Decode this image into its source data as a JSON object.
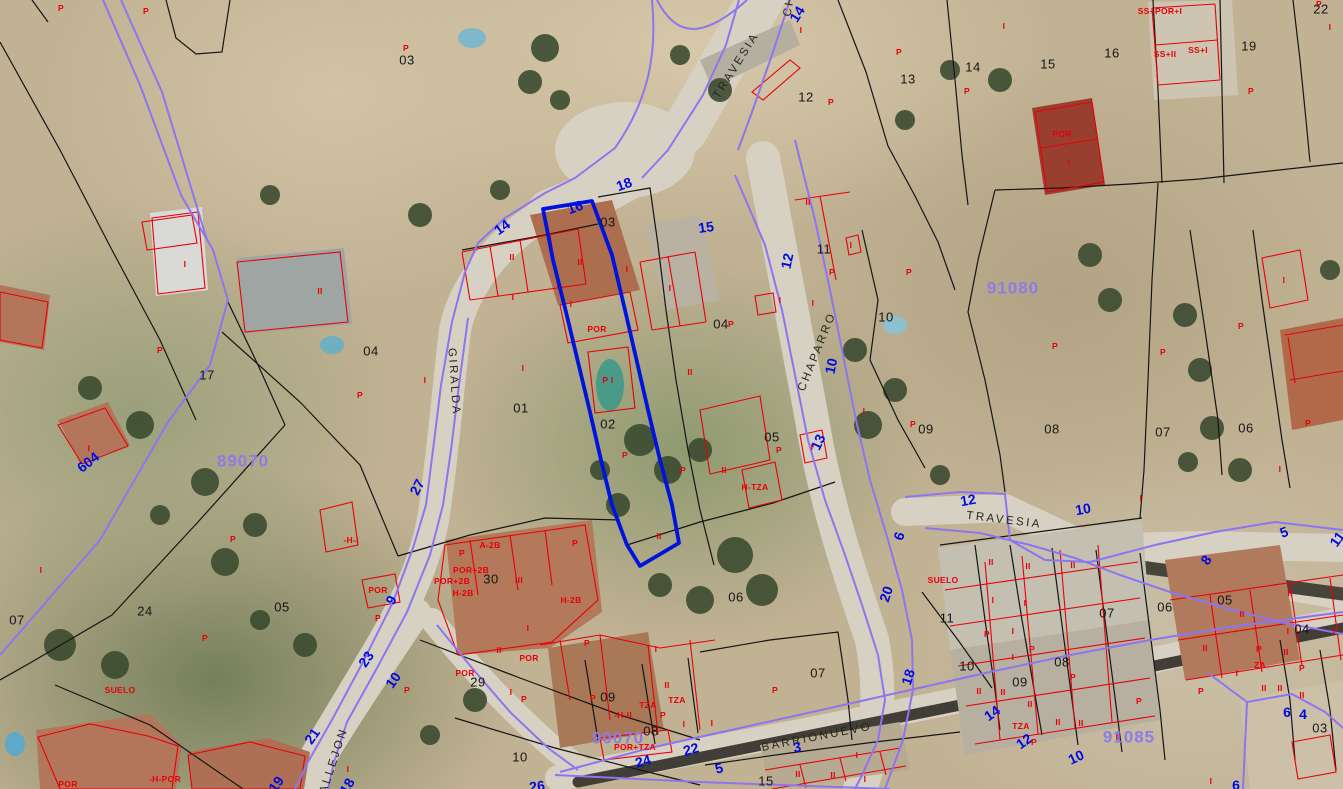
{
  "map": {
    "type": "cadastral-aerial-view",
    "colors": {
      "selected_parcel": "#0013dc",
      "parcel_lines": "#151515",
      "building_lines": "#e80008",
      "street_boundary": "#8d75f0",
      "street_numbers": "#0009e2",
      "block_numbers": "#8d7ce8",
      "building_labels": "#e80008",
      "street_names": "#26261c"
    },
    "street_names": [
      {
        "text": "TRAVESIA",
        "x": 737,
        "y": 66,
        "rot": -58
      },
      {
        "text": "GIRALDA",
        "x": 453,
        "y": 382,
        "rot": 86
      },
      {
        "text": "CHAPARRO",
        "x": 818,
        "y": 352,
        "rot": -68
      },
      {
        "text": "TRAVESIA",
        "x": 1004,
        "y": 521,
        "rot": 7
      },
      {
        "text": "BARRIONUEVO",
        "x": 817,
        "y": 738,
        "rot": -11
      },
      {
        "text": "CALLEJON",
        "x": 333,
        "y": 766,
        "rot": -72
      },
      {
        "text": "CH",
        "x": 790,
        "y": 6,
        "rot": -80
      }
    ],
    "street_numbers": [
      {
        "text": "14",
        "x": 797,
        "y": 14,
        "rot": -58
      },
      {
        "text": "18",
        "x": 624,
        "y": 184,
        "rot": -20
      },
      {
        "text": "16",
        "x": 575,
        "y": 207,
        "rot": -20
      },
      {
        "text": "15",
        "x": 706,
        "y": 227,
        "rot": -8
      },
      {
        "text": "14",
        "x": 502,
        "y": 227,
        "rot": -35
      },
      {
        "text": "12",
        "x": 787,
        "y": 261,
        "rot": -78
      },
      {
        "text": "10",
        "x": 831,
        "y": 366,
        "rot": -78
      },
      {
        "text": "13",
        "x": 818,
        "y": 442,
        "rot": -65
      },
      {
        "text": "27",
        "x": 417,
        "y": 487,
        "rot": -62
      },
      {
        "text": "9",
        "x": 391,
        "y": 600,
        "rot": -62
      },
      {
        "text": "23",
        "x": 366,
        "y": 659,
        "rot": -55
      },
      {
        "text": "10",
        "x": 393,
        "y": 680,
        "rot": -55
      },
      {
        "text": "21",
        "x": 312,
        "y": 736,
        "rot": -55
      },
      {
        "text": "19",
        "x": 276,
        "y": 784,
        "rot": -55
      },
      {
        "text": "18",
        "x": 347,
        "y": 786,
        "rot": -60
      },
      {
        "text": "604",
        "x": 88,
        "y": 462,
        "rot": -38
      },
      {
        "text": "20",
        "x": 886,
        "y": 594,
        "rot": -72
      },
      {
        "text": "6",
        "x": 899,
        "y": 536,
        "rot": -72
      },
      {
        "text": "18",
        "x": 908,
        "y": 677,
        "rot": -72
      },
      {
        "text": "12",
        "x": 968,
        "y": 500,
        "rot": -10
      },
      {
        "text": "10",
        "x": 1083,
        "y": 509,
        "rot": -10
      },
      {
        "text": "8",
        "x": 1206,
        "y": 560,
        "rot": -55
      },
      {
        "text": "5",
        "x": 1284,
        "y": 532,
        "rot": -20
      },
      {
        "text": "11",
        "x": 1337,
        "y": 539,
        "rot": -55
      },
      {
        "text": "14",
        "x": 992,
        "y": 713,
        "rot": -35
      },
      {
        "text": "12",
        "x": 1024,
        "y": 741,
        "rot": -35
      },
      {
        "text": "10",
        "x": 1076,
        "y": 757,
        "rot": -25
      },
      {
        "text": "6",
        "x": 1287,
        "y": 712,
        "rot": 0
      },
      {
        "text": "4",
        "x": 1303,
        "y": 714,
        "rot": 0
      },
      {
        "text": "26",
        "x": 537,
        "y": 786,
        "rot": -8
      },
      {
        "text": "24",
        "x": 643,
        "y": 761,
        "rot": -15
      },
      {
        "text": "22",
        "x": 691,
        "y": 749,
        "rot": -15
      },
      {
        "text": "5",
        "x": 719,
        "y": 768,
        "rot": -15
      },
      {
        "text": "3",
        "x": 797,
        "y": 747,
        "rot": -12
      },
      {
        "text": "6",
        "x": 1236,
        "y": 785,
        "rot": 0
      }
    ],
    "block_numbers": [
      {
        "text": "89070",
        "x": 243,
        "y": 461
      },
      {
        "text": "91080",
        "x": 1013,
        "y": 288
      },
      {
        "text": "90070",
        "x": 618,
        "y": 738
      },
      {
        "text": "91085",
        "x": 1129,
        "y": 737
      }
    ],
    "parcel_numbers": [
      {
        "text": "03",
        "x": 407,
        "y": 60
      },
      {
        "text": "12",
        "x": 806,
        "y": 97
      },
      {
        "text": "13",
        "x": 908,
        "y": 79
      },
      {
        "text": "14",
        "x": 973,
        "y": 67
      },
      {
        "text": "15",
        "x": 1048,
        "y": 64
      },
      {
        "text": "16",
        "x": 1112,
        "y": 53
      },
      {
        "text": "19",
        "x": 1249,
        "y": 46
      },
      {
        "text": "22",
        "x": 1321,
        "y": 9
      },
      {
        "text": "03",
        "x": 608,
        "y": 222
      },
      {
        "text": "11",
        "x": 824,
        "y": 249
      },
      {
        "text": "04",
        "x": 721,
        "y": 324
      },
      {
        "text": "10",
        "x": 886,
        "y": 317
      },
      {
        "text": "17",
        "x": 207,
        "y": 375
      },
      {
        "text": "04",
        "x": 371,
        "y": 351
      },
      {
        "text": "01",
        "x": 521,
        "y": 408
      },
      {
        "text": "02",
        "x": 608,
        "y": 424
      },
      {
        "text": "05",
        "x": 772,
        "y": 437
      },
      {
        "text": "09",
        "x": 926,
        "y": 429
      },
      {
        "text": "08",
        "x": 1052,
        "y": 429
      },
      {
        "text": "07",
        "x": 1163,
        "y": 432
      },
      {
        "text": "06",
        "x": 1246,
        "y": 428
      },
      {
        "text": "07",
        "x": 17,
        "y": 620
      },
      {
        "text": "24",
        "x": 145,
        "y": 611
      },
      {
        "text": "05",
        "x": 282,
        "y": 607
      },
      {
        "text": "30",
        "x": 491,
        "y": 579
      },
      {
        "text": "06",
        "x": 736,
        "y": 597
      },
      {
        "text": "29",
        "x": 478,
        "y": 682
      },
      {
        "text": "10",
        "x": 520,
        "y": 757
      },
      {
        "text": "09",
        "x": 608,
        "y": 697
      },
      {
        "text": "08",
        "x": 651,
        "y": 731
      },
      {
        "text": "07",
        "x": 818,
        "y": 673
      },
      {
        "text": "15",
        "x": 766,
        "y": 781
      },
      {
        "text": "11",
        "x": 947,
        "y": 618
      },
      {
        "text": "10",
        "x": 967,
        "y": 666
      },
      {
        "text": "09",
        "x": 1020,
        "y": 682
      },
      {
        "text": "08",
        "x": 1062,
        "y": 662
      },
      {
        "text": "07",
        "x": 1107,
        "y": 613
      },
      {
        "text": "06",
        "x": 1165,
        "y": 607
      },
      {
        "text": "05",
        "x": 1225,
        "y": 600
      },
      {
        "text": "04",
        "x": 1302,
        "y": 629
      },
      {
        "text": "03",
        "x": 1320,
        "y": 728
      }
    ],
    "building_labels": [
      {
        "text": "P",
        "x": 61,
        "y": 8
      },
      {
        "text": "P",
        "x": 146,
        "y": 11
      },
      {
        "text": "P",
        "x": 406,
        "y": 48
      },
      {
        "text": "I",
        "x": 801,
        "y": 30
      },
      {
        "text": "P",
        "x": 899,
        "y": 52
      },
      {
        "text": "P",
        "x": 831,
        "y": 102
      },
      {
        "text": "P",
        "x": 967,
        "y": 91
      },
      {
        "text": "I",
        "x": 1004,
        "y": 26
      },
      {
        "text": "SS+POR+I",
        "x": 1160,
        "y": 11
      },
      {
        "text": "SS+II",
        "x": 1165,
        "y": 54
      },
      {
        "text": "SS+I",
        "x": 1198,
        "y": 50
      },
      {
        "text": "P",
        "x": 1319,
        "y": 4
      },
      {
        "text": "I",
        "x": 1330,
        "y": 27
      },
      {
        "text": "P",
        "x": 1251,
        "y": 91
      },
      {
        "text": "POR",
        "x": 1062,
        "y": 134
      },
      {
        "text": "I",
        "x": 1069,
        "y": 163
      },
      {
        "text": "II",
        "x": 808,
        "y": 202
      },
      {
        "text": "I",
        "x": 185,
        "y": 264
      },
      {
        "text": "II",
        "x": 320,
        "y": 291
      },
      {
        "text": "P",
        "x": 160,
        "y": 350
      },
      {
        "text": "II",
        "x": 512,
        "y": 257
      },
      {
        "text": "II",
        "x": 580,
        "y": 262
      },
      {
        "text": "I",
        "x": 627,
        "y": 269
      },
      {
        "text": "I",
        "x": 513,
        "y": 297
      },
      {
        "text": "I",
        "x": 571,
        "y": 304
      },
      {
        "text": "I",
        "x": 670,
        "y": 288
      },
      {
        "text": "POR",
        "x": 597,
        "y": 329
      },
      {
        "text": "P I",
        "x": 608,
        "y": 380
      },
      {
        "text": "I",
        "x": 523,
        "y": 368
      },
      {
        "text": "II",
        "x": 690,
        "y": 372
      },
      {
        "text": "I",
        "x": 780,
        "y": 300
      },
      {
        "text": "P",
        "x": 731,
        "y": 324
      },
      {
        "text": "I",
        "x": 851,
        "y": 245
      },
      {
        "text": "P",
        "x": 832,
        "y": 272
      },
      {
        "text": "P",
        "x": 909,
        "y": 272
      },
      {
        "text": "I",
        "x": 813,
        "y": 303
      },
      {
        "text": "P",
        "x": 1055,
        "y": 346
      },
      {
        "text": "I",
        "x": 864,
        "y": 411
      },
      {
        "text": "P",
        "x": 913,
        "y": 424
      },
      {
        "text": "P",
        "x": 360,
        "y": 395
      },
      {
        "text": "I",
        "x": 425,
        "y": 380
      },
      {
        "text": "I",
        "x": 89,
        "y": 448
      },
      {
        "text": "I",
        "x": 41,
        "y": 570
      },
      {
        "text": "P",
        "x": 233,
        "y": 539
      },
      {
        "text": "-H-I",
        "x": 351,
        "y": 540
      },
      {
        "text": "P",
        "x": 205,
        "y": 638
      },
      {
        "text": "SUELO",
        "x": 120,
        "y": 690
      },
      {
        "text": "POR",
        "x": 68,
        "y": 784
      },
      {
        "text": "-H-POR",
        "x": 165,
        "y": 779
      },
      {
        "text": "POR",
        "x": 378,
        "y": 590
      },
      {
        "text": "P",
        "x": 378,
        "y": 618
      },
      {
        "text": "I",
        "x": 348,
        "y": 769
      },
      {
        "text": "P",
        "x": 407,
        "y": 690
      },
      {
        "text": "A-2B",
        "x": 490,
        "y": 545
      },
      {
        "text": "POR+2B",
        "x": 471,
        "y": 570
      },
      {
        "text": "POR+2B",
        "x": 452,
        "y": 581
      },
      {
        "text": "H-2B",
        "x": 463,
        "y": 593
      },
      {
        "text": "III",
        "x": 519,
        "y": 580
      },
      {
        "text": "P",
        "x": 462,
        "y": 553
      },
      {
        "text": "P",
        "x": 575,
        "y": 543
      },
      {
        "text": "H-2B",
        "x": 571,
        "y": 600
      },
      {
        "text": "I",
        "x": 528,
        "y": 628
      },
      {
        "text": "II",
        "x": 499,
        "y": 650
      },
      {
        "text": "POR",
        "x": 529,
        "y": 658
      },
      {
        "text": "POR",
        "x": 465,
        "y": 673
      },
      {
        "text": "I",
        "x": 511,
        "y": 692
      },
      {
        "text": "P",
        "x": 524,
        "y": 699
      },
      {
        "text": "P",
        "x": 587,
        "y": 643
      },
      {
        "text": "I",
        "x": 656,
        "y": 649
      },
      {
        "text": "P",
        "x": 625,
        "y": 455
      },
      {
        "text": "P",
        "x": 683,
        "y": 470
      },
      {
        "text": "II",
        "x": 724,
        "y": 470
      },
      {
        "text": "H-TZA",
        "x": 755,
        "y": 487
      },
      {
        "text": "P",
        "x": 779,
        "y": 450
      },
      {
        "text": "I",
        "x": 812,
        "y": 447
      },
      {
        "text": "II",
        "x": 659,
        "y": 536
      },
      {
        "text": "II",
        "x": 667,
        "y": 685
      },
      {
        "text": "TZA",
        "x": 648,
        "y": 705
      },
      {
        "text": "TZA",
        "x": 677,
        "y": 700
      },
      {
        "text": "-H-II",
        "x": 623,
        "y": 715
      },
      {
        "text": "P",
        "x": 663,
        "y": 715
      },
      {
        "text": "I",
        "x": 684,
        "y": 724
      },
      {
        "text": "I",
        "x": 712,
        "y": 723
      },
      {
        "text": "POR+TZA",
        "x": 635,
        "y": 747
      },
      {
        "text": "P",
        "x": 593,
        "y": 698
      },
      {
        "text": "P",
        "x": 775,
        "y": 690
      },
      {
        "text": "II",
        "x": 798,
        "y": 774
      },
      {
        "text": "II",
        "x": 833,
        "y": 775
      },
      {
        "text": "I",
        "x": 857,
        "y": 755
      },
      {
        "text": "I",
        "x": 865,
        "y": 779
      },
      {
        "text": "SUELO",
        "x": 943,
        "y": 580
      },
      {
        "text": "II",
        "x": 991,
        "y": 562
      },
      {
        "text": "II",
        "x": 1028,
        "y": 566
      },
      {
        "text": "II",
        "x": 1073,
        "y": 565
      },
      {
        "text": "I",
        "x": 993,
        "y": 600
      },
      {
        "text": "I",
        "x": 1025,
        "y": 603
      },
      {
        "text": "I",
        "x": 1060,
        "y": 608
      },
      {
        "text": "P",
        "x": 987,
        "y": 634
      },
      {
        "text": "I",
        "x": 1013,
        "y": 631
      },
      {
        "text": "P",
        "x": 1032,
        "y": 649
      },
      {
        "text": "I",
        "x": 1013,
        "y": 657
      },
      {
        "text": "P",
        "x": 1073,
        "y": 677
      },
      {
        "text": "II",
        "x": 979,
        "y": 691
      },
      {
        "text": "II",
        "x": 1003,
        "y": 692
      },
      {
        "text": "II",
        "x": 1030,
        "y": 704
      },
      {
        "text": "TZA",
        "x": 1021,
        "y": 726
      },
      {
        "text": "II",
        "x": 1058,
        "y": 722
      },
      {
        "text": "II",
        "x": 1081,
        "y": 723
      },
      {
        "text": "P",
        "x": 1034,
        "y": 742
      },
      {
        "text": "P",
        "x": 1139,
        "y": 701
      },
      {
        "text": "I",
        "x": 1117,
        "y": 737
      },
      {
        "text": "I",
        "x": 1141,
        "y": 498
      },
      {
        "text": "II",
        "x": 1290,
        "y": 593
      },
      {
        "text": "II",
        "x": 1242,
        "y": 614
      },
      {
        "text": "II",
        "x": 1205,
        "y": 648
      },
      {
        "text": "I",
        "x": 1288,
        "y": 631
      },
      {
        "text": "I",
        "x": 1334,
        "y": 631
      },
      {
        "text": "P",
        "x": 1259,
        "y": 649
      },
      {
        "text": "II",
        "x": 1286,
        "y": 652
      },
      {
        "text": "P",
        "x": 1302,
        "y": 668
      },
      {
        "text": "ZA",
        "x": 1260,
        "y": 665
      },
      {
        "text": "I",
        "x": 1237,
        "y": 673
      },
      {
        "text": "II",
        "x": 1264,
        "y": 688
      },
      {
        "text": "II",
        "x": 1280,
        "y": 688
      },
      {
        "text": "II",
        "x": 1302,
        "y": 695
      },
      {
        "text": "P",
        "x": 1201,
        "y": 691
      },
      {
        "text": "I",
        "x": 1211,
        "y": 781
      },
      {
        "text": "I",
        "x": 1284,
        "y": 280
      },
      {
        "text": "P",
        "x": 1241,
        "y": 326
      },
      {
        "text": "P",
        "x": 1163,
        "y": 352
      },
      {
        "text": "P",
        "x": 1308,
        "y": 423
      },
      {
        "text": "I",
        "x": 1280,
        "y": 469
      }
    ]
  }
}
